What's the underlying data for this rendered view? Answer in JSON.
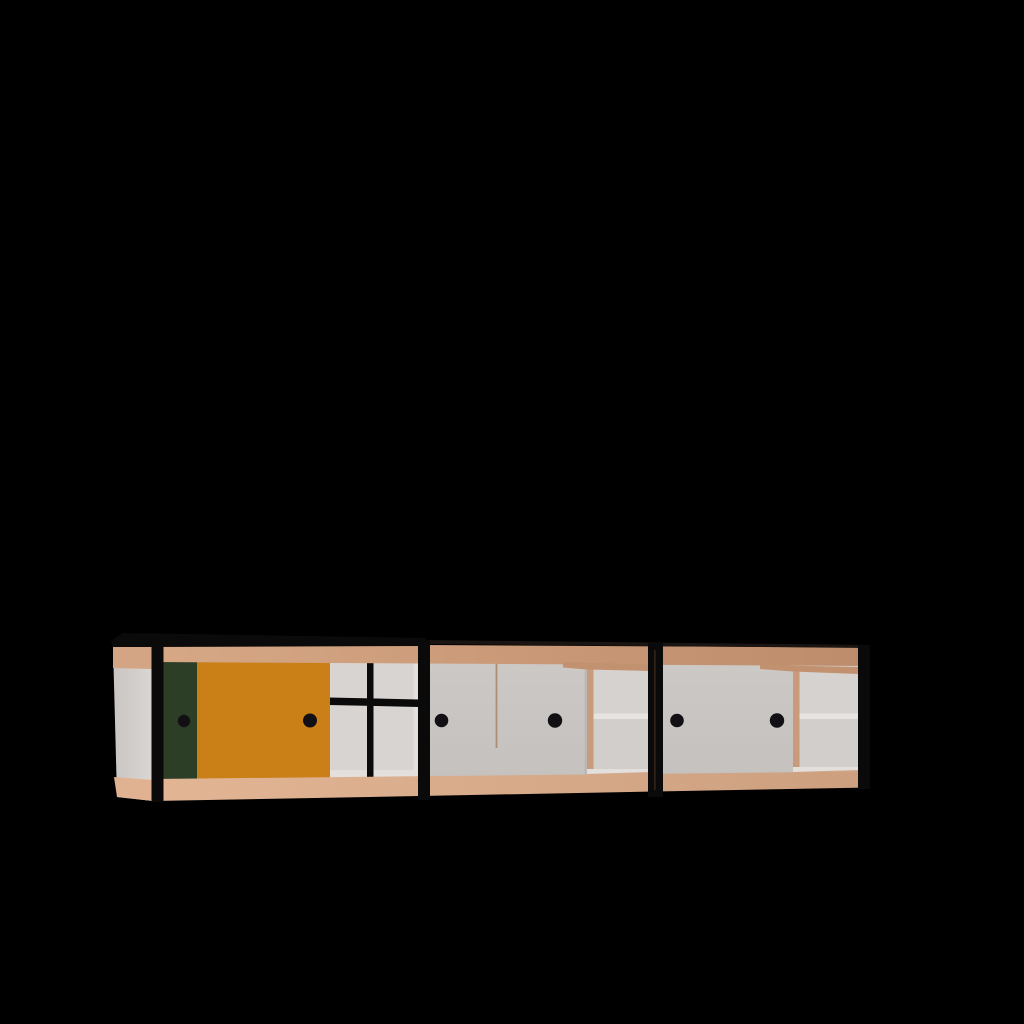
{
  "scene": {
    "object": "modernist-sideboard-3d-render",
    "sections": 3,
    "sliding_doors": 6,
    "handles": 6,
    "background": "#000000"
  },
  "colors": {
    "background": "#000000",
    "cap_black": "#0a0a0b",
    "frame_black": "#0b0a0b",
    "handle_black": "#121014",
    "hairline": "#1a1512",
    "post_gap_brown": "#4a3020",
    "wood_top_light": "#d7a885",
    "wood_top_dark": "#bd8c6b",
    "wood_bottom_light": "#e2b595",
    "wood_bottom_dark": "#cc9f7f",
    "wood_side_top": "#d4a584",
    "wood_side_bottom": "#e0b292",
    "wood_divider": "#c79b7c",
    "wood_soffit": "#c2916f",
    "wood_floor": "#d3a687",
    "door_green": "#2d3e27",
    "door_orange": "#ca8017",
    "door_white_top": "#ccc8c5",
    "door_white_bottom": "#c5c1be",
    "door_seam": "#a8815f",
    "door_edge_shadow": "#b4b0ad",
    "side_light": "#dad6d3",
    "side_dark": "#c9c5c2",
    "interior_white": "#d8d4d1",
    "interior_shadow": "#d2cecb",
    "shelf_face": "#d6d2cf",
    "shelf_highlight": "#e6e3e0",
    "floor_white": "#e2dfdc"
  }
}
